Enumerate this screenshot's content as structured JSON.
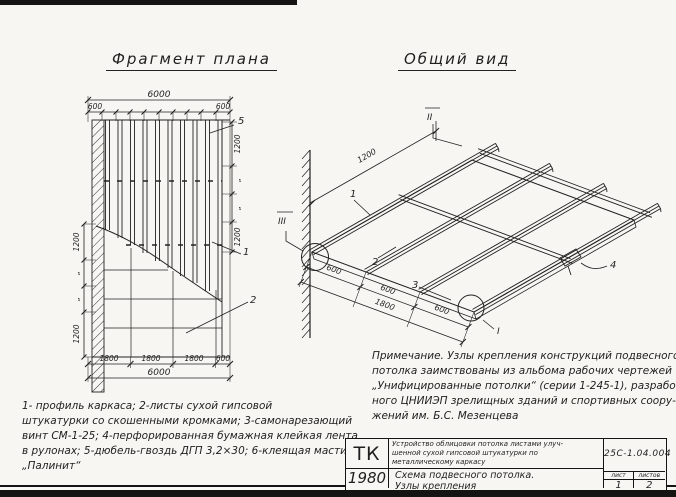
{
  "page": {
    "bg": "#f7f6f2",
    "ink": "#1f1f1f"
  },
  "plan": {
    "title": "Фрагмент плана",
    "dims": {
      "top_total": "6000",
      "top_left": "600",
      "top_right": "600",
      "right_chain": [
        "1200",
        "„",
        "„",
        "1200"
      ],
      "left_chain": [
        "1200",
        "„",
        "„",
        "1200"
      ],
      "bottom": [
        "1800",
        "1800",
        "1800",
        "600"
      ],
      "bottom_total": "6000"
    },
    "callouts": {
      "n5": "5",
      "n1": "1",
      "n2": "2"
    }
  },
  "iso": {
    "title": "Общий вид",
    "dims": {
      "length": "1200",
      "spacing": [
        "600",
        "600",
        "600"
      ],
      "spacing_total": "1800"
    },
    "callouts": {
      "n1": "1",
      "n2": "2",
      "n3": "3",
      "n4": "4"
    },
    "nodes": {
      "left": "III",
      "top": "II",
      "bottom_right": "I"
    }
  },
  "note": {
    "lines": [
      "Примечание. Узлы крепления конструкций подвесного",
      "потолка заимствованы из альбома рабочих чертежей",
      "„Унифицированные потолки“ (серии 1-245-1), разработан-",
      "ного ЦНИИЭП зрелищных зданий и спортивных соору-",
      "жений  им.  Б.С.  Мезенцева"
    ]
  },
  "legend": {
    "lines": [
      "1- профиль каркаса;  2-листы сухой гипсовой",
      "штукатурки со скошенными кромками;  3-самонарезающий",
      "винт СМ-1-25;  4-перфорированная бумажная клейкая лента",
      "в рулонах;  5-дюбель-гвоздь ДГП 3,2×30;  6-клеящая мастика",
      "„Палинит“"
    ]
  },
  "titleblock": {
    "code": "ТК",
    "year": "1980",
    "project_lines": [
      "Устройство облицовки потолка листами улуч-",
      "шенной сухой гипсовой штукатурки по",
      "металлическому каркасу"
    ],
    "sheet_title_lines": [
      "Схема подвесного потолка.",
      "Узлы крепления"
    ],
    "doc_number": "25С-1.04.004",
    "sheet_header": "лист",
    "sheets_header": "листов",
    "sheet_no": "1",
    "sheets_total": "2"
  }
}
